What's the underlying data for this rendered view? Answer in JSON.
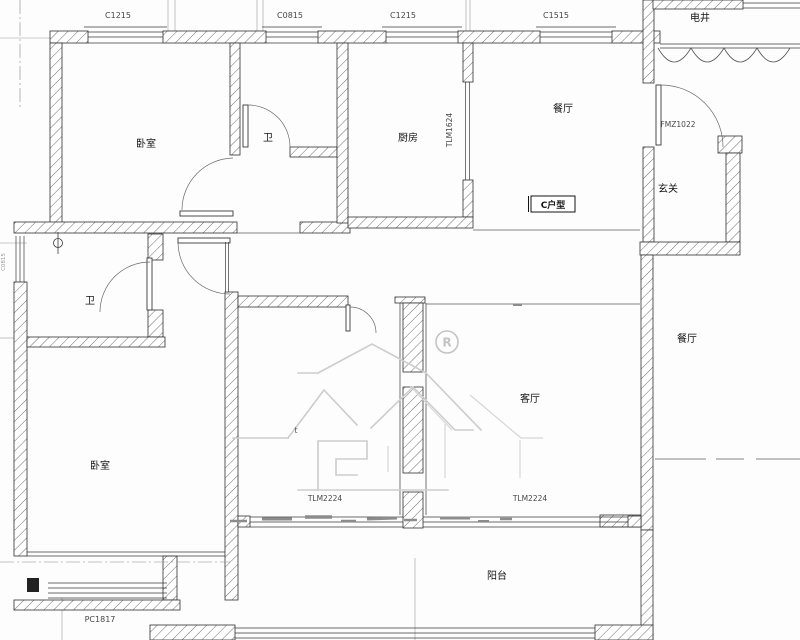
{
  "drawing": {
    "type": "apartment-floor-plan",
    "unit_type_label": "C户型",
    "rooms": [
      {
        "name": "bedroom-top",
        "label": "卧室"
      },
      {
        "name": "bathroom-top",
        "label": "卫"
      },
      {
        "name": "kitchen",
        "label": "厨房"
      },
      {
        "name": "dining-top",
        "label": "餐厅"
      },
      {
        "name": "electric-shaft",
        "label": "电井"
      },
      {
        "name": "foyer",
        "label": "玄关"
      },
      {
        "name": "bathroom-mid",
        "label": "卫"
      },
      {
        "name": "bedroom-bottom",
        "label": "卧室"
      },
      {
        "name": "living-room",
        "label": "客厅"
      },
      {
        "name": "dining-right",
        "label": "餐厅"
      },
      {
        "name": "balcony",
        "label": "阳台"
      }
    ],
    "window_tags": [
      {
        "name": "window-c1215-left",
        "label": "C1215"
      },
      {
        "name": "window-c0815-top",
        "label": "C0815"
      },
      {
        "name": "window-c1215-mid",
        "label": "C1215"
      },
      {
        "name": "window-c1515",
        "label": "C1515"
      },
      {
        "name": "window-pc1817",
        "label": "PC1817"
      },
      {
        "name": "window-left-edge",
        "label": "C0815"
      }
    ],
    "door_tags": [
      {
        "name": "entry-fire-door",
        "label": "FMZ1022"
      },
      {
        "name": "kitchen-sliding-door",
        "label": "TLM1624"
      },
      {
        "name": "balcony-sliding-door-left",
        "label": "TLM2224"
      },
      {
        "name": "balcony-sliding-door-right",
        "label": "TLM2224"
      }
    ],
    "watermark": {
      "registered_mark": "R",
      "small_mark": "t"
    },
    "colors": {
      "background": "#fdfdfd",
      "wall_line": "#2f2f2f",
      "hatch": "#6f6f6f",
      "watermark_gray": "#cdcdcd",
      "label_text": "#141414",
      "code_text": "#474747"
    }
  }
}
